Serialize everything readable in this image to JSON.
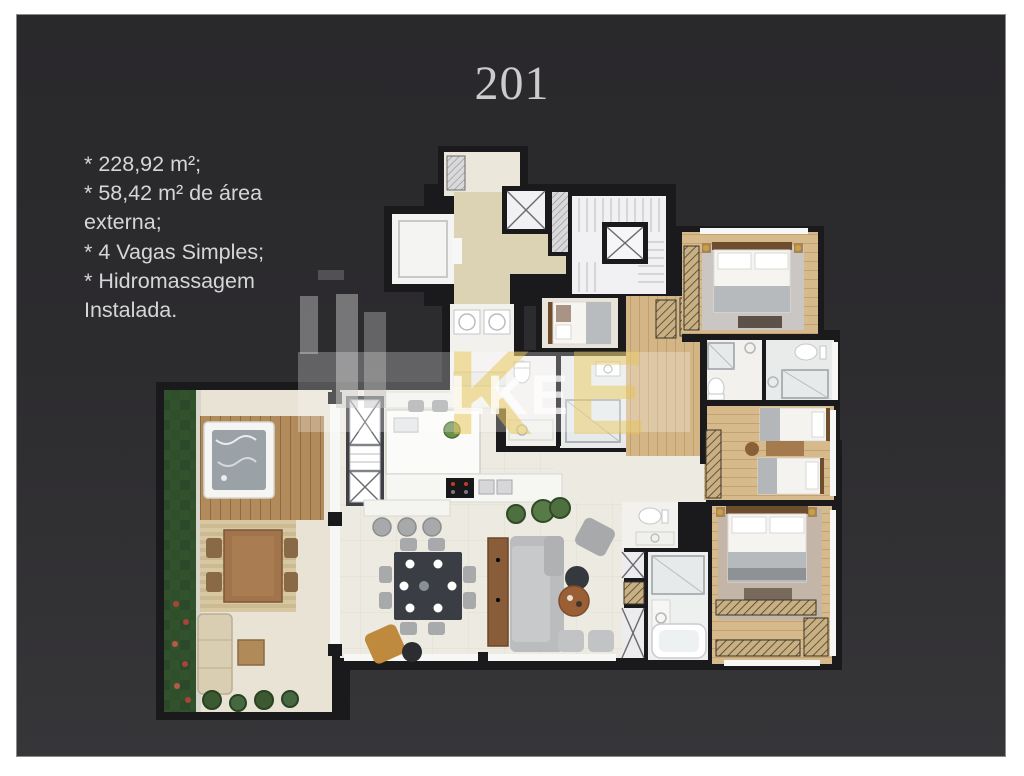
{
  "slide": {
    "title": "201",
    "specs": [
      "* 228,92 m²;",
      "* 58,42 m² de área externa;",
      "* 4 Vagas Simples;",
      "* Hidromassagem Instalada."
    ]
  },
  "watermark": {
    "text": "LKE",
    "k": "K",
    "e": "E"
  },
  "colors": {
    "page-bg": "#ffffff",
    "slide-top": "#29282b",
    "slide-bottom": "#363538",
    "title-text": "#cbcbcd",
    "body-text": "#d6d6d8",
    "wall": "#1a191c",
    "hall-beige": "#dcd2b4",
    "tile-cream": "#edeae1",
    "terrace-tile": "#e9e3d5",
    "wood-floor": "#d6ba8c",
    "grass-green": "#32522e",
    "deck-wood": "#b28b5c",
    "sofa-gray": "#bbbcbe",
    "dining-table": "#3a3e44",
    "watermark-yellow": "#e8c550"
  }
}
